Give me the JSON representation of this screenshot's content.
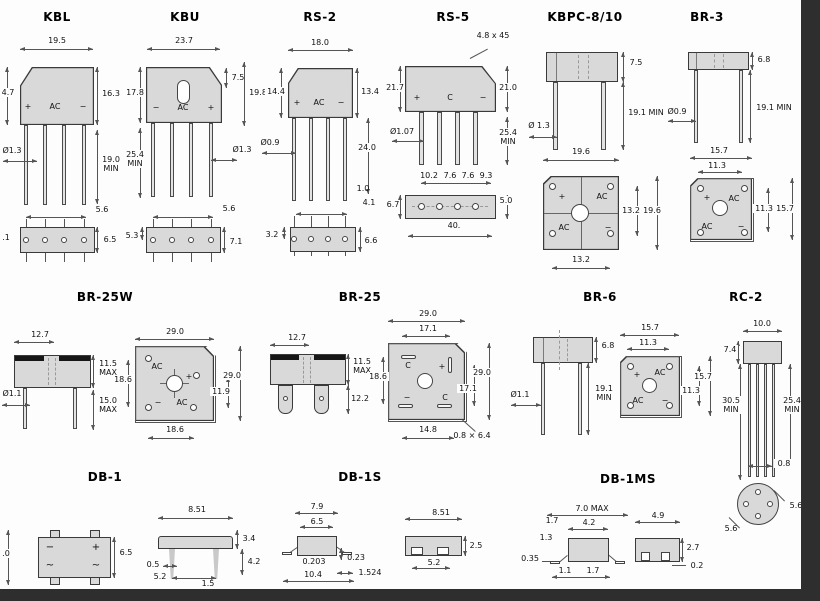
{
  "page": {
    "edge_bar_color": "#2e2e2e"
  },
  "p": {
    "kbl": {
      "title": "KBL",
      "top_width": "19.5",
      "left_h": "4.7",
      "right_h": "16.3",
      "lead_len": "19.0\nMIN",
      "lead_dia": "Ø1.3",
      "pitch": "5.6",
      "bottom_left": ".1",
      "bottom_h": "6.5",
      "marks": {
        "plus": "+",
        "ac": "AC",
        "minus": "−"
      }
    },
    "kbu": {
      "title": "KBU",
      "top_width": "23.7",
      "slot_off": "7.5",
      "left_h": "17.8",
      "right_h": "19.8",
      "lead_len": "25.4\nMIN",
      "lead_dia": "Ø1.3",
      "pitch": "5.6",
      "bottom_left": "5.3",
      "bottom_h": "7.1",
      "marks": {
        "minus": "−",
        "ac": "AC",
        "plus": "+"
      }
    },
    "rs2": {
      "title": "RS-2",
      "top_width": "18.0",
      "left_h": "14.4",
      "right_h": "13.4",
      "lead_len": "24.0",
      "standoff": "1.0",
      "offset": "4.1",
      "lead_dia": "Ø0.9",
      "bottom_left": "3.2",
      "bottom_h": "6.6",
      "marks": {
        "plus": "+",
        "ac": "AC",
        "minus": "−"
      }
    },
    "rs5": {
      "title": "RS-5",
      "chamfer": "4.8 x 45",
      "left_h": "21.7",
      "right_h": "21.0",
      "lead_len": "25.4\nMIN",
      "lead_dia": "Ø1.07",
      "p1": "10.2",
      "p2": "7.6",
      "p3": "7.6",
      "p4": "9.3",
      "bv_left": "6.7",
      "bv_right": "5.0",
      "bv_width": "40.",
      "marks": {
        "plus": "+",
        "c": "C",
        "minus": "−"
      }
    },
    "kbpc": {
      "title": "KBPC-8/10",
      "body_h": "7.5",
      "lead_len": "19.1 MIN",
      "lead_dia": "Ø 1.3",
      "width": "19.6",
      "sq_inner": "13.2",
      "sq_outer": "19.6",
      "sq_bottom": "13.2",
      "marks": {
        "plus": "+",
        "ac1": "AC",
        "ac2": "AC",
        "minus": "−"
      }
    },
    "br3": {
      "title": "BR-3",
      "body_h": "6.8",
      "lead_len": "19.1 MIN",
      "lead_dia": "Ø0.9",
      "sq_top": "15.7",
      "sq_inner_top": "11.3",
      "sq_inner_right": "11.3",
      "sq_right": "15.7",
      "marks": {
        "plus": "+",
        "ac1": "AC",
        "ac2": "AC",
        "minus": "−"
      }
    },
    "br25w": {
      "title": "BR-25W",
      "side_top": "12.7",
      "body_h": "11.5\nMAX",
      "lead_len": "15.0\nMAX",
      "lead_dia": "Ø1.1",
      "sq_top": "29.0",
      "sq_right": "29.0",
      "sq_left": "18.6",
      "sq_inner_right": "11.9",
      "sq_bottom": "18.6",
      "marks": {
        "ac1": "AC",
        "plus": "+",
        "minus": "−",
        "ac2": "AC"
      }
    },
    "br25": {
      "title": "BR-25",
      "side_top": "12.7",
      "body_h": "11.5\nMAX",
      "tab_len": "12.2",
      "sq_top": "29.0",
      "sq_inner_top": "17.1",
      "sq_left": "18.6",
      "sq_right": "29.0",
      "sq_inner_right": "17.1",
      "sq_bottom": "14.8",
      "note": "0.8 × 6.4",
      "marks": {
        "c1": "C",
        "plus": "+",
        "minus": "−",
        "c2": "C"
      }
    },
    "br6": {
      "title": "BR-6",
      "body_h": "6.8",
      "lead_len": "19.1\nMIN",
      "lead_dia": "Ø1.1",
      "sq_top": "15.7",
      "sq_inner_top": "11.3",
      "sq_inner_right": "11.3",
      "sq_right": "15.7",
      "marks": {
        "plus": "+",
        "ac1": "AC",
        "ac2": "AC",
        "minus": "−"
      }
    },
    "rc2": {
      "title": "RC-2",
      "top_width": "10.0",
      "body_h": "7.4",
      "lead_len_l": "30.5\nMIN",
      "lead_len_r": "25.4\nMIN",
      "lead_w": "0.8",
      "cv_d1": "5.6",
      "cv_d2": "5.6"
    },
    "db1": {
      "title": "DB-1",
      "left_frag": ".0",
      "body_h": "6.5",
      "side_top": "8.51",
      "d_body": "3.4",
      "d_lead": "4.2",
      "lead_w": "0.5",
      "pitch": "5.2",
      "d_off": "1.5",
      "marks": {
        "minus": "−",
        "plus": "+",
        "ac1": "~",
        "ac2": "~"
      }
    },
    "db1s": {
      "title": "DB-1S",
      "w1": "7.9",
      "w2": "6.5",
      "t1": "0.203",
      "t2": "0.23",
      "w3": "10.4",
      "t3": "1.524",
      "sv_top": "8.51",
      "sv_h": "2.5",
      "sv_pitch": "5.2"
    },
    "db1ms": {
      "title": "DB-1MS",
      "w1": "7.0 MAX",
      "d1": "1.7",
      "w2": "4.2",
      "d2": "1.3",
      "d3": "0.35",
      "d4": "1.1",
      "d5": "1.7",
      "sv_top": "4.9",
      "sv_h": "2.7",
      "sv_d": "0.2"
    }
  }
}
